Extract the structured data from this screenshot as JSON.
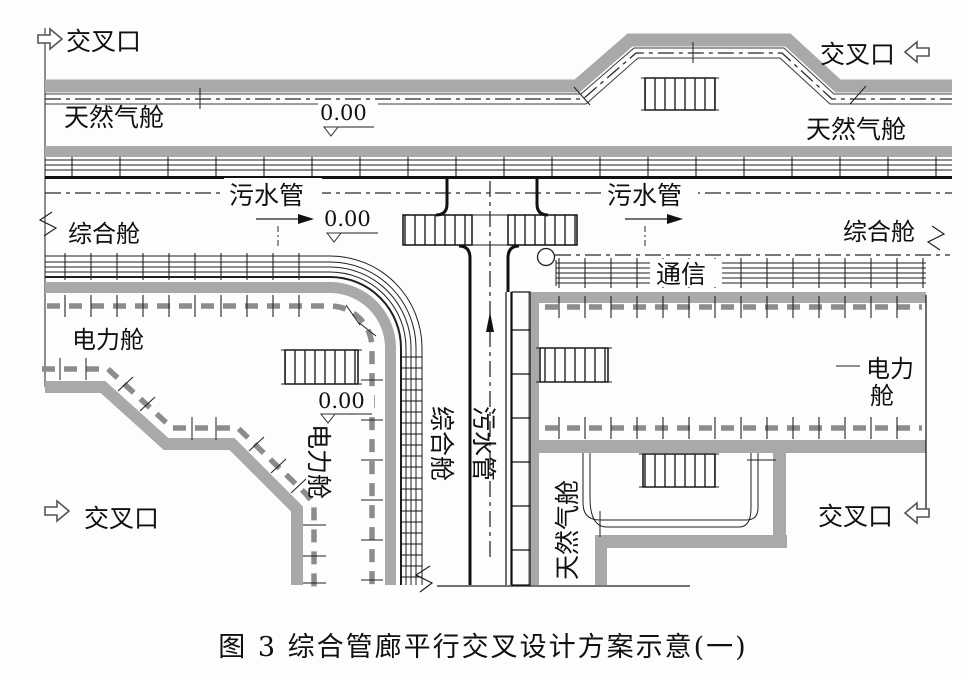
{
  "diagram": {
    "type": "engineering-plan",
    "subject": "utility tunnel parallel crossing design",
    "caption": "图 3  综合管廊平行交叉设计方案示意(一)"
  },
  "colors": {
    "band_gray": "#a9a9a9",
    "cable_dash_gray": "#8c8c8c",
    "line_black": "#1f1f1f",
    "background": "#fdfdfd"
  },
  "labels": {
    "intersection_top_left": "交叉口",
    "intersection_top_right": "交叉口",
    "intersection_bottom_left": "交叉口",
    "intersection_bottom_right": "交叉口",
    "gas_left": "天然气舱",
    "gas_right": "天然气舱",
    "gas_vertical": "天然气舱",
    "sewage_left": "污水管",
    "sewage_right": "污水管",
    "sewage_vertical": "污水管",
    "utility_left": "综合舱",
    "utility_right": "综合舱",
    "utility_vertical": "综合舱",
    "power_left": "电力舱",
    "power_vertical": "电力舱",
    "power_right_line1": "电力",
    "power_right_line2": "舱",
    "communication": "通信",
    "elevation_top": "0.00",
    "elevation_mid": "0.00",
    "elevation_low": "0.00"
  },
  "icons": {
    "open_arrows": "direction-arrow-icon (open outline arrows pointing into drawing at each 交叉口)",
    "flow_arrows": "flow-arrow-icon (solid arrowheads showing flow in 综合舱 and 污水管)",
    "manhole": "manhole-circle-icon",
    "elevation_marker": "elevation-triangle-icon",
    "ladder": "ladder-hatch-icon",
    "break_mark": "break-zigzag-icon"
  }
}
